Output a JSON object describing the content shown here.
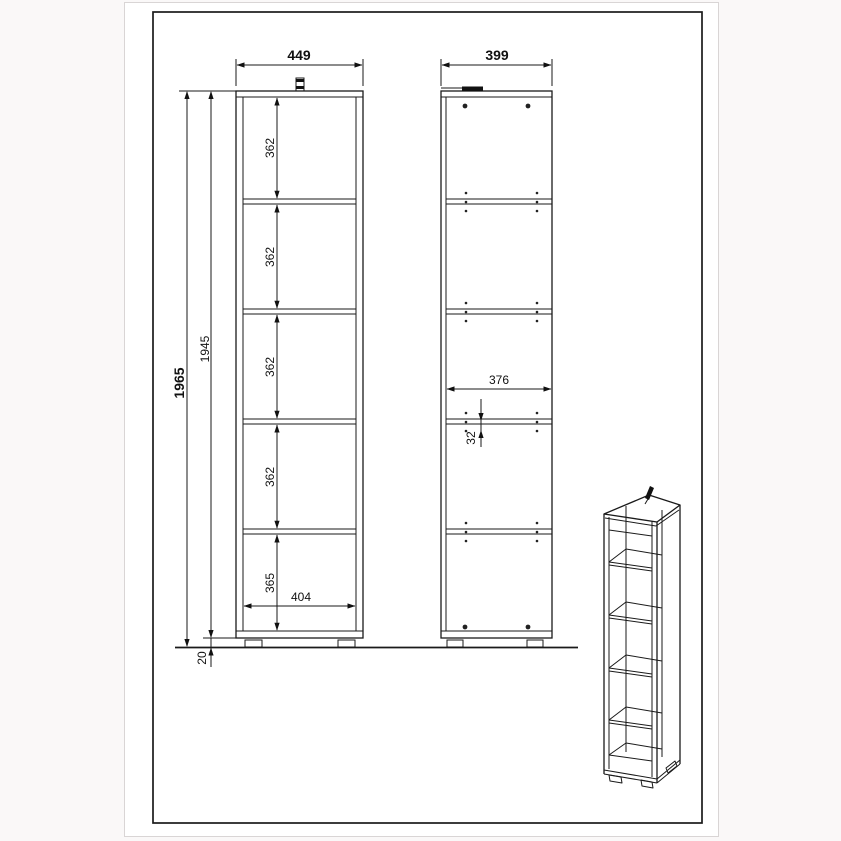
{
  "colors": {
    "page_background": "#faf8f8",
    "sheet": "#ffffff",
    "line": "#1a1a1a"
  },
  "dims": {
    "front": {
      "width_outer": "449",
      "height_total": "1965",
      "height_body": "1945",
      "shelf_spacings": [
        "362",
        "362",
        "362",
        "362",
        "365"
      ],
      "width_inner": "404",
      "plinth_height": "20"
    },
    "side": {
      "depth_outer": "399",
      "depth_inner": "376",
      "pin_spacing": "32"
    }
  }
}
